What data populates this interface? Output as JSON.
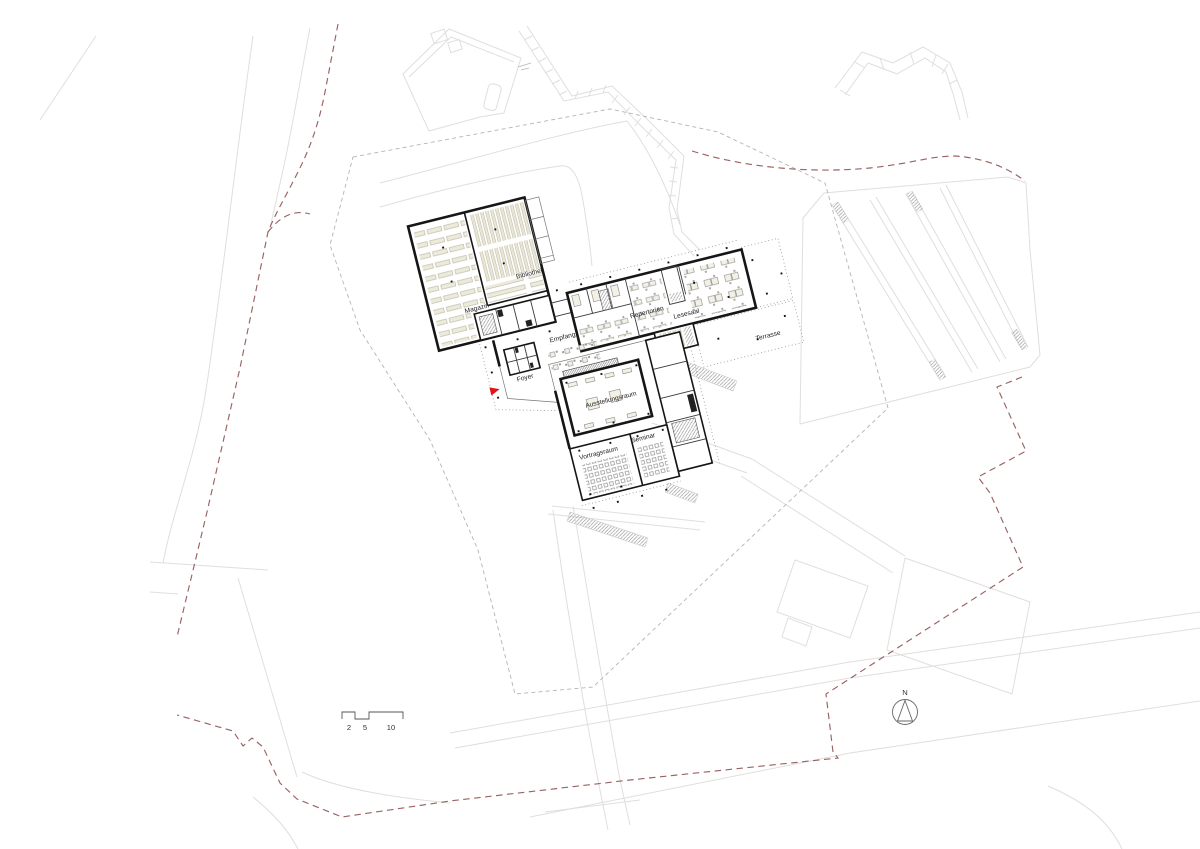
{
  "document": {
    "kind": "architectural site / floor plan drawing"
  },
  "plan": {
    "rooms": {
      "bibliothek": "Bibliothek",
      "magazin": "Magazin",
      "empfang": "Empfang",
      "foyer": "Foyer",
      "repertorien": "Repertorien",
      "lesesaal": "Lesesaal",
      "terrasse": "Terrasse",
      "ausstellungsraum": "Ausstellungsraum",
      "vortragsraum": "Vortragsraum",
      "seminar": "Seminar"
    }
  },
  "compass": {
    "north_label": "N"
  },
  "scale_bar": {
    "tick_labels": [
      "2",
      "5",
      "10"
    ]
  },
  "colors": {
    "boundary_red_dashed": "#9a6262",
    "parcel_gray_dashed": "#b7b3b1",
    "context_gray": "#e1dedd",
    "wall_black": "#161616",
    "furniture_fill": "#f3f1e6",
    "entrance_arrow_red": "#e21313"
  }
}
